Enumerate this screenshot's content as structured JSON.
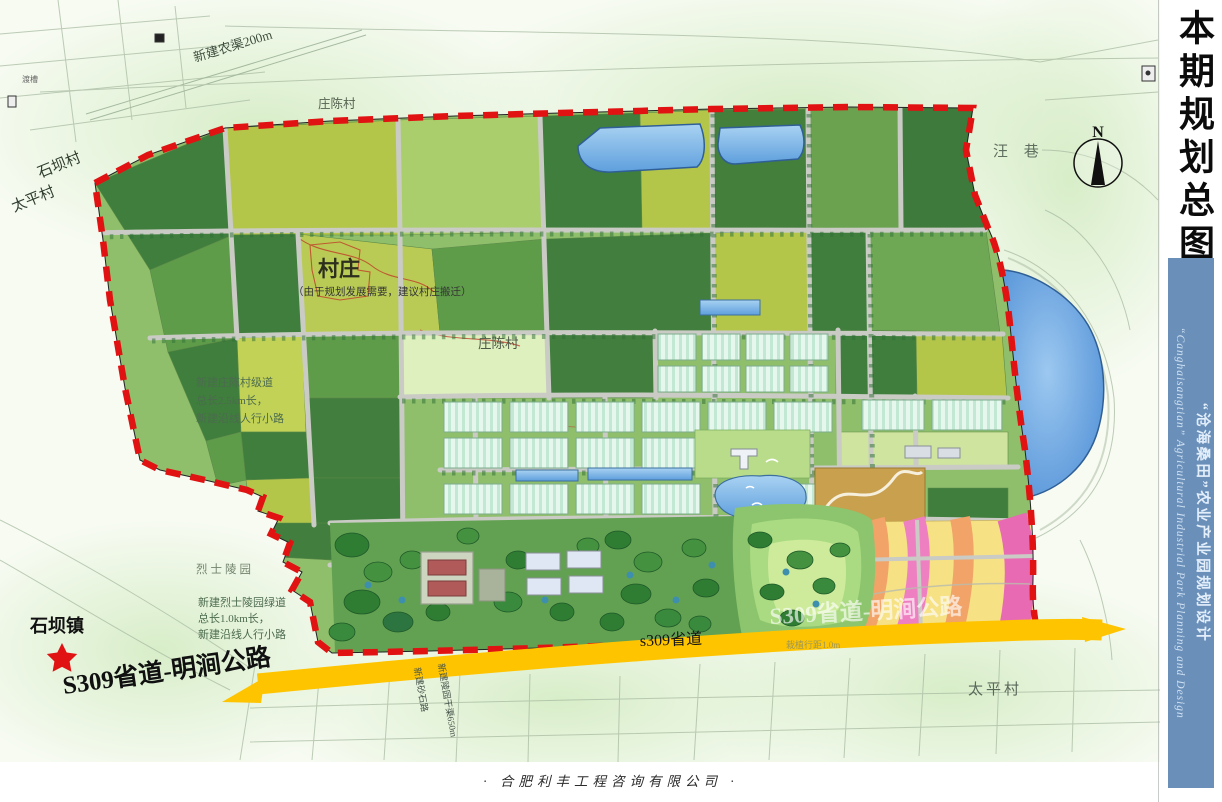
{
  "page": {
    "footer_credit": "·  合肥利丰工程咨询有限公司  ·"
  },
  "side_panel": {
    "title": "本期规划总图",
    "strip_zh": "“沧海桑田”农业产业园规划设计",
    "strip_en": "“Canghaisangtian” Agricultural Industrial Park Planning and Design"
  },
  "map": {
    "compass_label": "N",
    "labels": {
      "canal": "新建农渠200m",
      "duchao": "渡槽",
      "shibacun": "石坝村",
      "taipingcun": "太平村",
      "zhuangchencun": "庄陈村",
      "wangxiang": "汪  巷",
      "village": "村庄",
      "village_note": "（由于规划发展需要，建议村庄搬迁）",
      "note_mid_1": "新建庄陈村级道",
      "note_mid_2": "总长2.5km长，",
      "note_mid_3": "新建沿线人行小路",
      "martyr_park": "烈士陵园",
      "note_south_1": "新建烈士陵园绿道",
      "note_south_2": "总长1.0km长，",
      "note_south_3": "新建沿线人行小路",
      "shibazhen": "石坝镇",
      "s309_full": "S309省道-明涧公路",
      "s309_short": "s309省道",
      "road_label_a": "新建砂石路",
      "road_label_b": "新建陵园干渠650m",
      "spacing_note": "栽植行距1.0m"
    },
    "colors": {
      "boundary_red": "#e01212",
      "highway_yellow": "#ffc400",
      "water_blue": "#6fa9e2",
      "strip_blue": "#6a90ba"
    }
  }
}
